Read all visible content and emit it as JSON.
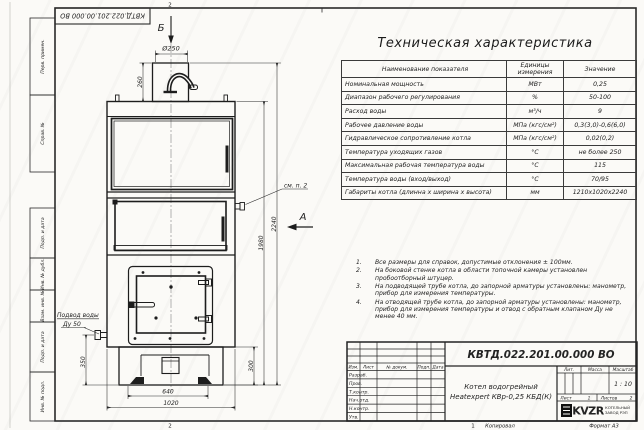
{
  "sheet": {
    "stamp_top": "КВТД.022.201.00.000 ВО",
    "zones": {
      "top": "2",
      "bottom": "2",
      "bottom_right": "1"
    },
    "margin_fields": [
      "Перв. примен.",
      "Справ. №",
      "Подп. и дата",
      "Инв. № дубл.",
      "Взам. инв. №",
      "Подп. и дата",
      "Инв. № подл."
    ],
    "copied_label": "Копировал",
    "format_label": "Формат А3"
  },
  "drawing": {
    "view_top_label": "Б",
    "view_side_label": "А",
    "callout_fitting": "см. п. 2",
    "callout_water_line1": "Подвод воды",
    "callout_water_line2": "Ду 50",
    "dims": {
      "chimney_diameter": "Ø250",
      "chimney_height": "260",
      "total_height": "2240",
      "body_height": "1980",
      "inlet_height": "350",
      "base_height": "300",
      "base_width": "640",
      "body_width": "1020"
    }
  },
  "spec_table": {
    "title": "Техническая характеристика",
    "headers": [
      "Наименование показателя",
      "Единицы измерения",
      "Значение"
    ],
    "rows": [
      {
        "name": "Номинальная мощность",
        "unit": "МВт",
        "value": "0,25"
      },
      {
        "name": "Диапазон рабочего регулирования",
        "unit": "%",
        "value": "50-100"
      },
      {
        "name": "Расход воды",
        "unit": "м³/ч",
        "value": "9"
      },
      {
        "name": "Рабочее давление воды",
        "unit": "МПа (кгс/см²)",
        "value": "0,3(3,0)-0,6(6,0)"
      },
      {
        "name": "Гидравлическое сопротивление котла",
        "unit": "МПа (кгс/см²)",
        "value": "0,02(0,2)"
      },
      {
        "name": "Температура уходящих газов",
        "unit": "°С",
        "value": "не более 250"
      },
      {
        "name": "Максимальная рабочая температура воды",
        "unit": "°С",
        "value": "115"
      },
      {
        "name": "Температура воды (вход/выход)",
        "unit": "°С",
        "value": "70/95"
      },
      {
        "name": "Габариты котла (длинна х ширина х высота)",
        "unit": "мм",
        "value": "1210х1020х2240"
      }
    ]
  },
  "notes": {
    "items": [
      {
        "num": "1.",
        "text": "Все размеры для справок, допустимые отклонения ± 100мм."
      },
      {
        "num": "2.",
        "text": "На боковой стенке котла в области топочной камеры установлен пробоотборный штуцер."
      },
      {
        "num": "3.",
        "text": "На подводящей трубе котла, до запорной арматуры установлены: манометр, прибор для измерения температуры."
      },
      {
        "num": "4.",
        "text": "На отводящей трубе котла, до запорной арматуры установлены: манометр, прибор для измерения температуры и отвод с обратным клапаном Ду не менее 40 мм."
      }
    ]
  },
  "title_block": {
    "doc_number": "КВТД.022.201.00.000 ВО",
    "product_name_line1": "Котел водогрейный",
    "product_name_line2": "Heatexpert КВр-0,25 КБД(К)",
    "columns": [
      "Изм.",
      "Лист",
      "№ докум.",
      "Подп.",
      "Дата"
    ],
    "rows": [
      "Разраб.",
      "Пров.",
      "Т.контр.",
      "Нач.отд.",
      "Н.контр.",
      "Утв."
    ],
    "lit_label": "Лит.",
    "mass_label": "Масса",
    "scale_label": "Масштаб",
    "scale_value": "1 : 10",
    "sheet_label": "Лист",
    "sheet_value": "1",
    "sheets_label": "Листов",
    "sheets_value": "2",
    "logo_text": "KVZR",
    "logo_line1": "КОТЕЛЬНЫЙ",
    "logo_line2": "ЗАВОД РЭП"
  }
}
